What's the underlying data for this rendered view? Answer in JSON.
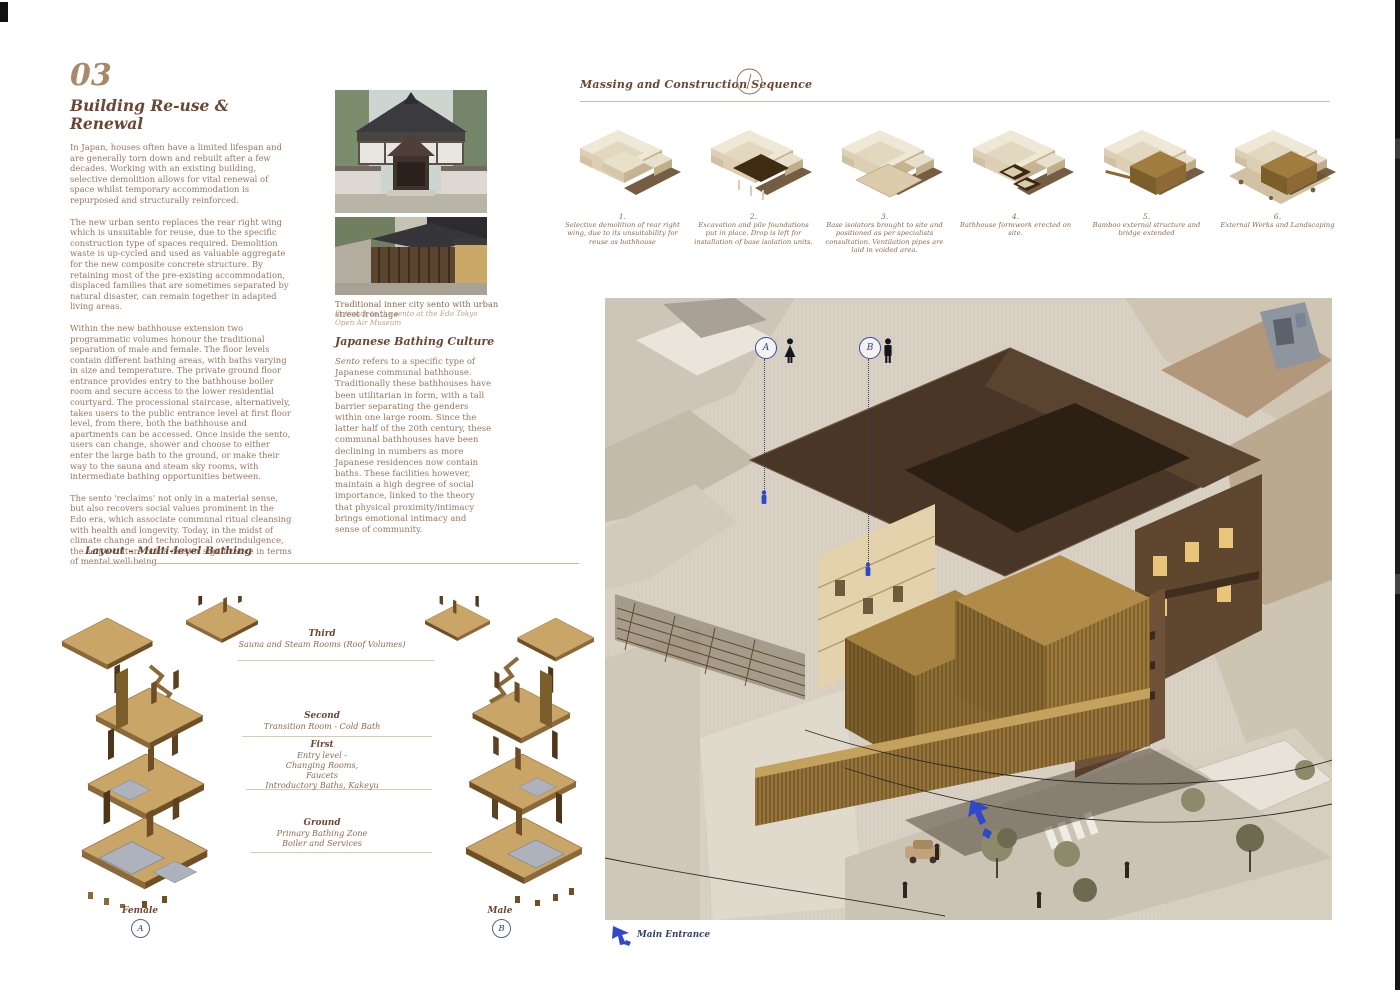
{
  "page": {
    "section_number": "03",
    "title_line1": "Building Re-use &",
    "title_line2": "Renewal"
  },
  "intro": {
    "paragraphs": [
      "In Japan, houses often have a limited lifespan and are generally torn down and rebuilt after a few decades. Working with an existing building, selective demolition allows for vital renewal of space whilst temporary accommodation is repurposed and structurally reinforced.",
      "The new urban sento replaces the rear right wing which is unsuitable for reuse, due to the specific construction type of spaces required. Demolition waste is up-cycled and used as valuable aggregate for the new composite concrete structure. By retaining most of the pre-existing accommodation, displaced families that are sometimes separated by natural disaster, can remain together in adapted living areas.",
      "Within the new bathhouse extension two programmatic volumes honour the traditional separation of male and female. The floor levels contain different bathing areas, with baths varying in size and temperature. The private ground floor entrance provides entry to the bathhouse boiler room and secure access to the lower residential courtyard. The processional staircase, alternatively, takes users to the public entrance level at first floor level, from there, both the bathhouse and apartments can be accessed. Once inside the sento, users can change, shower and choose to either enter the large bath to the ground, or make their way to the sauna and steam sky rooms, with intermediate bathing opportunities between.",
      "The sento 'reclaims' not only in a material sense, but also recovers social values prominent in the Edo era, which associate communal ritual cleansing with health and longevity. Today, in the midst of climate change and technological overindulgence, the sento culture holds deeper significance in terms of mental well-being."
    ]
  },
  "photos": {
    "caption": "Traditional inner city sento with urban street frontage",
    "subcaption": "Entrance to the sento at the Edo Tokyo Open Air Museum"
  },
  "bathing_culture": {
    "heading": "Japanese Bathing Culture",
    "lead_word": "Sento",
    "body": " refers to a specific type of Japanese communal bathhouse. Traditionally these bathhouses have been utilitarian in form, with a tall barrier separating the genders within one large room. Since the latter half of the 20th century, these communal bathhouses have been declining in numbers as more Japanese residences now contain baths. These facilities however, maintain a high degree of social importance, linked to the theory that physical proximity/intimacy brings emotional intimacy and sense of community."
  },
  "massing": {
    "heading": "Massing and Construction Sequence",
    "steps": [
      {
        "number": "1.",
        "caption": "Selective demolition of rear right wing, due to its unsuitability for reuse as bathhouse"
      },
      {
        "number": "2.",
        "caption": "Excavation and pile foundations put in place. Drop is left for installation of base isolation units."
      },
      {
        "number": "3.",
        "caption": "Base isolators brought to site and positioned as per specialists consultation. Ventilation pipes are laid in voided area."
      },
      {
        "number": "4.",
        "caption": "Bathhouse formwork erected on site."
      },
      {
        "number": "5.",
        "caption": "Bamboo external structure and bridge extended"
      },
      {
        "number": "6.",
        "caption": "External Works and Landscaping"
      }
    ]
  },
  "layout_section": {
    "heading": "Layout – Multi-level Bathing",
    "levels": [
      {
        "name": "Third",
        "lines": [
          "Sauna and Steam Rooms (Roof Volumes)"
        ]
      },
      {
        "name": "Second",
        "lines": [
          "Transition Room - Cold Bath"
        ]
      },
      {
        "name": "First",
        "lines": [
          "Entry level -",
          "Changing Rooms,",
          "Faucets",
          "Introductory Baths, Kakeyu"
        ]
      },
      {
        "name": "Ground",
        "lines": [
          "Primary Bathing Zone",
          "Boiler and Services"
        ]
      }
    ],
    "female_label": "Female",
    "female_marker": "A",
    "male_label": "Male",
    "male_marker": "B"
  },
  "render": {
    "marker_a": "A",
    "marker_b": "B",
    "main_entrance_label": "Main Entrance"
  },
  "colors": {
    "accent_blue": "#2f49c8",
    "marker_navy": "#35406a",
    "heading_brown": "#6b4733",
    "body_brown": "#97765b",
    "rule_tan": "#cbb89e"
  }
}
